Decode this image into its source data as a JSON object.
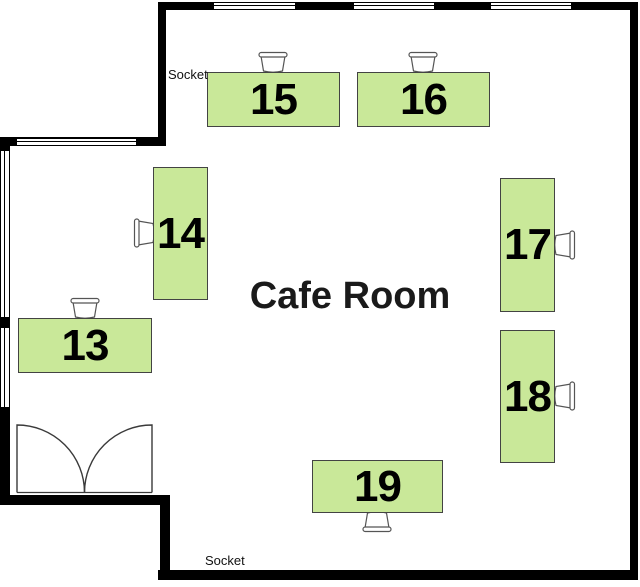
{
  "room": {
    "name": "Cafe Room",
    "socket_labels": {
      "top": "Socket",
      "bottom": "Socket"
    }
  },
  "desks": [
    {
      "id": "desk-13",
      "label": "13"
    },
    {
      "id": "desk-14",
      "label": "14"
    },
    {
      "id": "desk-15",
      "label": "15"
    },
    {
      "id": "desk-16",
      "label": "16"
    },
    {
      "id": "desk-17",
      "label": "17"
    },
    {
      "id": "desk-18",
      "label": "18"
    },
    {
      "id": "desk-19",
      "label": "19"
    }
  ],
  "colors": {
    "wall": "#000000",
    "desk_fill": "#c9e899",
    "desk_border": "#434343",
    "chair_stroke": "#555555"
  }
}
